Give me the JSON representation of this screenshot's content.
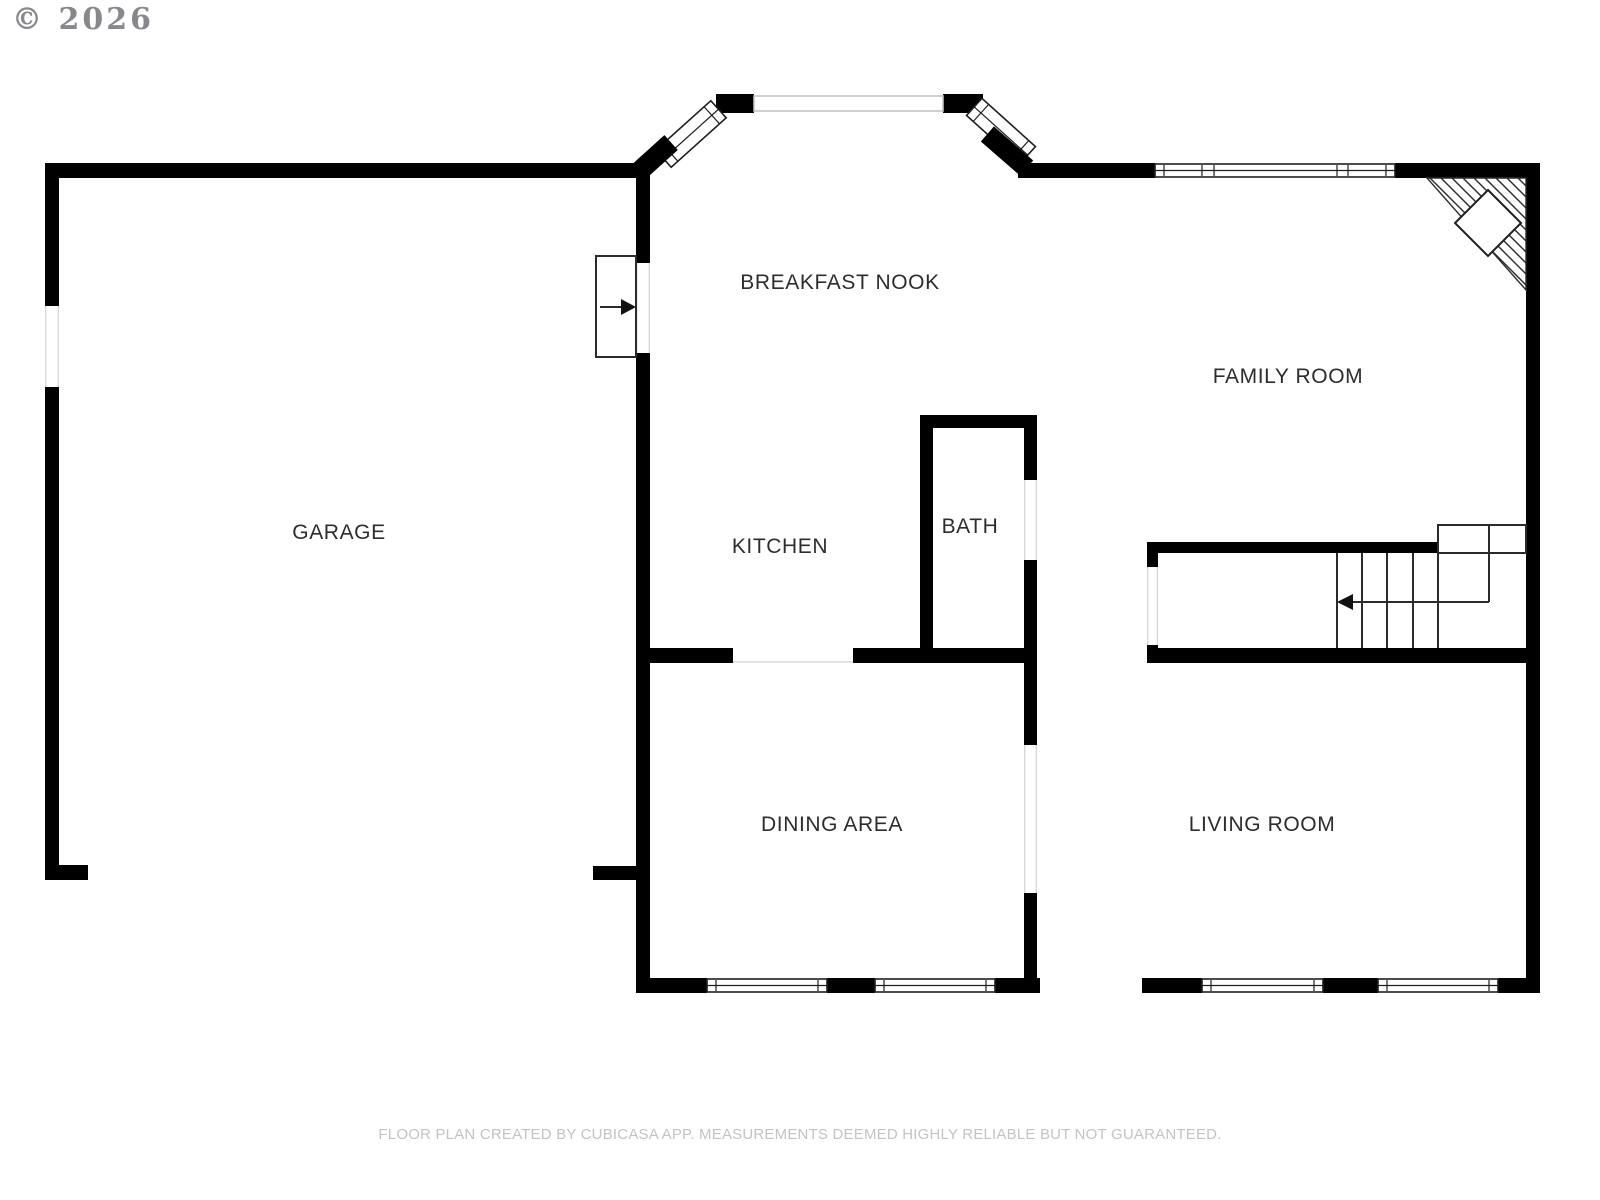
{
  "watermark": {
    "text": "© 2026"
  },
  "footer": {
    "text": "FLOOR PLAN CREATED BY CUBICASA APP. MEASUREMENTS DEEMED HIGHLY RELIABLE BUT NOT GUARANTEED."
  },
  "colors": {
    "background": "#ffffff",
    "wall": "#000000",
    "line": "#2b2b2b",
    "window_stroke": "#1f1f1f",
    "opening_edge": "#d8d8d8",
    "flat_window_stroke": "#c4c4c4",
    "label": "#2d2d2d",
    "watermark": "#87878c",
    "footer": "#c3c3c3"
  },
  "rooms": [
    {
      "id": "garage",
      "name": "GARAGE",
      "x": 339,
      "y": 533
    },
    {
      "id": "breakfast-nook",
      "name": "BREAKFAST NOOK",
      "x": 840,
      "y": 283
    },
    {
      "id": "family-room",
      "name": "FAMILY ROOM",
      "x": 1288,
      "y": 377
    },
    {
      "id": "kitchen",
      "name": "KITCHEN",
      "x": 780,
      "y": 547
    },
    {
      "id": "bath",
      "name": "BATH",
      "x": 970,
      "y": 527
    },
    {
      "id": "dining-area",
      "name": "DINING AREA",
      "x": 832,
      "y": 825
    },
    {
      "id": "living-room",
      "name": "LIVING ROOM",
      "x": 1262,
      "y": 825
    }
  ],
  "geometry": {
    "canvas": {
      "w": 1600,
      "h": 1200
    },
    "walls": [
      [
        45,
        163,
        605,
        15
      ],
      [
        45,
        163,
        14,
        143
      ],
      [
        45,
        387,
        14,
        493
      ],
      [
        45,
        865,
        43,
        15
      ],
      [
        593,
        866,
        57,
        14
      ],
      [
        636,
        163,
        14,
        100
      ],
      [
        636,
        353,
        14,
        640
      ],
      [
        716,
        94,
        38,
        19
      ],
      [
        943,
        94,
        40,
        19
      ],
      [
        1018,
        163,
        137,
        15
      ],
      [
        1395,
        163,
        145,
        15
      ],
      [
        1526,
        163,
        14,
        830
      ],
      [
        920,
        415,
        13,
        248
      ],
      [
        920,
        415,
        117,
        13
      ],
      [
        1024,
        428,
        13,
        52
      ],
      [
        1024,
        560,
        13,
        185
      ],
      [
        1024,
        893,
        13,
        100
      ],
      [
        636,
        648,
        97,
        15
      ],
      [
        853,
        648,
        184,
        15
      ],
      [
        636,
        978,
        71,
        15
      ],
      [
        827,
        978,
        48,
        15
      ],
      [
        995,
        978,
        45,
        15
      ],
      [
        1142,
        978,
        60,
        15
      ],
      [
        1323,
        978,
        55,
        15
      ],
      [
        1498,
        978,
        42,
        15
      ],
      [
        1147,
        542,
        291,
        11
      ],
      [
        1147,
        542,
        11,
        25
      ],
      [
        1147,
        645,
        11,
        18
      ],
      [
        1147,
        648,
        393,
        15
      ]
    ],
    "openings": [
      {
        "x": 45,
        "y": 306,
        "w": 14,
        "h": 81,
        "o": "v"
      },
      {
        "x": 636,
        "y": 263,
        "w": 14,
        "h": 90,
        "o": "v"
      },
      {
        "x": 1024,
        "y": 480,
        "w": 13,
        "h": 80,
        "o": "v"
      },
      {
        "x": 1024,
        "y": 745,
        "w": 13,
        "h": 148,
        "o": "v"
      },
      {
        "x": 1147,
        "y": 567,
        "w": 11,
        "h": 78,
        "o": "v"
      }
    ],
    "pass_line": {
      "x1": 733,
      "y1": 662,
      "x2": 853,
      "y2": 662
    },
    "windows": [
      {
        "x": 1155,
        "y": 164,
        "w": 240,
        "h": 13,
        "divs": [
          1164,
          1202,
          1214,
          1337,
          1348,
          1386
        ]
      },
      {
        "x": 707,
        "y": 979,
        "w": 120,
        "h": 13,
        "divs": [
          716,
          818
        ]
      },
      {
        "x": 875,
        "y": 979,
        "w": 120,
        "h": 13,
        "divs": [
          884,
          986
        ]
      },
      {
        "x": 1202,
        "y": 979,
        "w": 121,
        "h": 13,
        "divs": [
          1211,
          1314
        ]
      },
      {
        "x": 1378,
        "y": 979,
        "w": 120,
        "h": 13,
        "divs": [
          1387,
          1489
        ]
      }
    ],
    "flat_window": {
      "x": 754,
      "y": 96,
      "w": 189,
      "h": 15
    },
    "rot_windows": [
      {
        "cx": 691,
        "cy": 134,
        "len": 74,
        "wid": 23,
        "angle": -42
      },
      {
        "cx": 1001,
        "cy": 131,
        "len": 72,
        "wid": 23,
        "angle": 42
      }
    ],
    "rot_blocks": [
      {
        "cx": 654,
        "cy": 158,
        "len": 46,
        "wid": 20,
        "angle": -42
      },
      {
        "cx": 1007,
        "cy": 151,
        "len": 52,
        "wid": 20,
        "angle": 41
      }
    ],
    "door": {
      "leaf": [
        596,
        256,
        40,
        101
      ],
      "arrow": {
        "x1": 600,
        "y1": 307,
        "x2": 624,
        "y2": 307
      },
      "head": "636,307 621,299 621,315"
    },
    "stairs": {
      "treads": {
        "xs": [
          1337,
          1362,
          1387,
          1413,
          1438
        ],
        "y1": 553,
        "y2": 648
      },
      "partial": {
        "x": 1489,
        "y1": 553,
        "y2": 602
      },
      "landing": {
        "x": 1438,
        "y": 525,
        "w": 88,
        "h": 28,
        "div_x": 1489
      },
      "arrow": {
        "x1": 1489,
        "y1": 602,
        "x2": 1350,
        "y2": 602
      },
      "head": "1337,602 1353,594 1353,610"
    },
    "fireplace": {
      "triangle": "1427,178 1526,178 1526,290",
      "hatch": {
        "x0": 1287,
        "x1": 1526,
        "step": 11,
        "y": 178,
        "run": 140
      },
      "diamond": "1488,190 1521,223 1488,256 1455,223"
    }
  }
}
